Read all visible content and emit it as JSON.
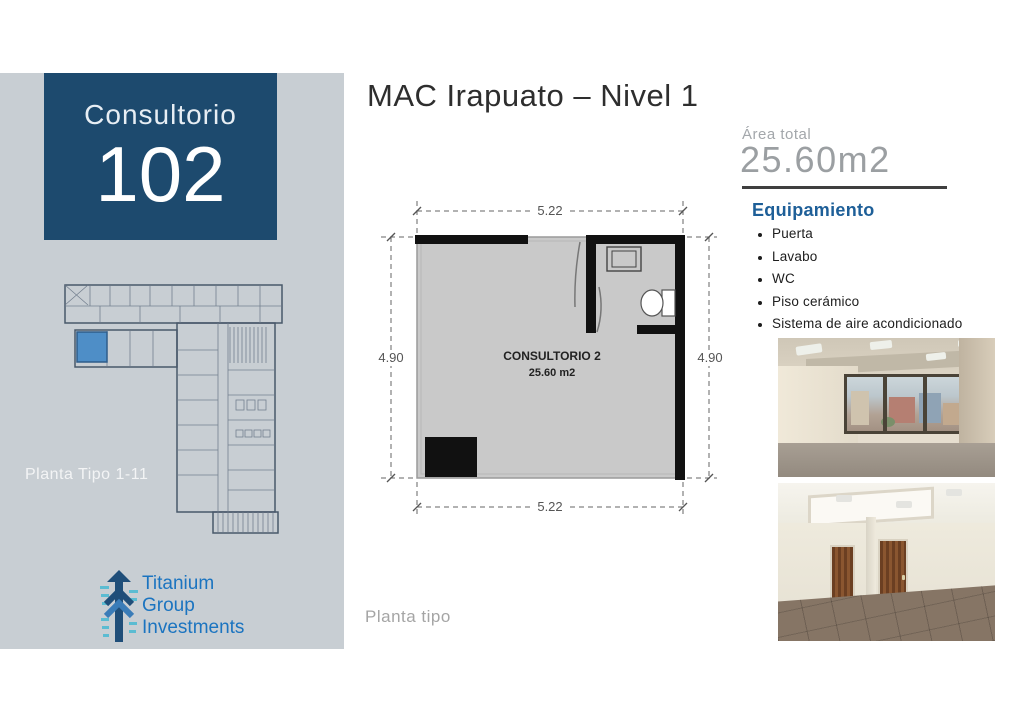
{
  "header": {
    "title": "MAC Irapuato – Nivel 1"
  },
  "sidebar": {
    "bg_color": "#c8ced3",
    "unit_box": {
      "bg_color": "#1d4a6e",
      "label": "Consultorio",
      "number": "102"
    },
    "building_plan": {
      "caption": "Planta Tipo 1-11",
      "highlight_color": "#4e8ec7"
    },
    "logo": {
      "lines": [
        "Titanium",
        "Group",
        "Investments"
      ],
      "text_color": "#1b74c0"
    }
  },
  "unit_plan": {
    "room_label": "CONSULTORIO 2",
    "room_area": "25.60 m2",
    "dim_top": "5.22",
    "dim_bottom": "5.22",
    "dim_left": "4.90",
    "dim_right": "4.90",
    "caption": "Planta tipo"
  },
  "details": {
    "area_label": "Área total",
    "area_value": "25.60m2",
    "equipment_title": "Equipamiento",
    "equipment_items": [
      "Puerta",
      "Lavabo",
      "WC",
      "Piso cerámico",
      "Sistema de aire acondicionado"
    ],
    "accent_color": "#1e5f98"
  }
}
